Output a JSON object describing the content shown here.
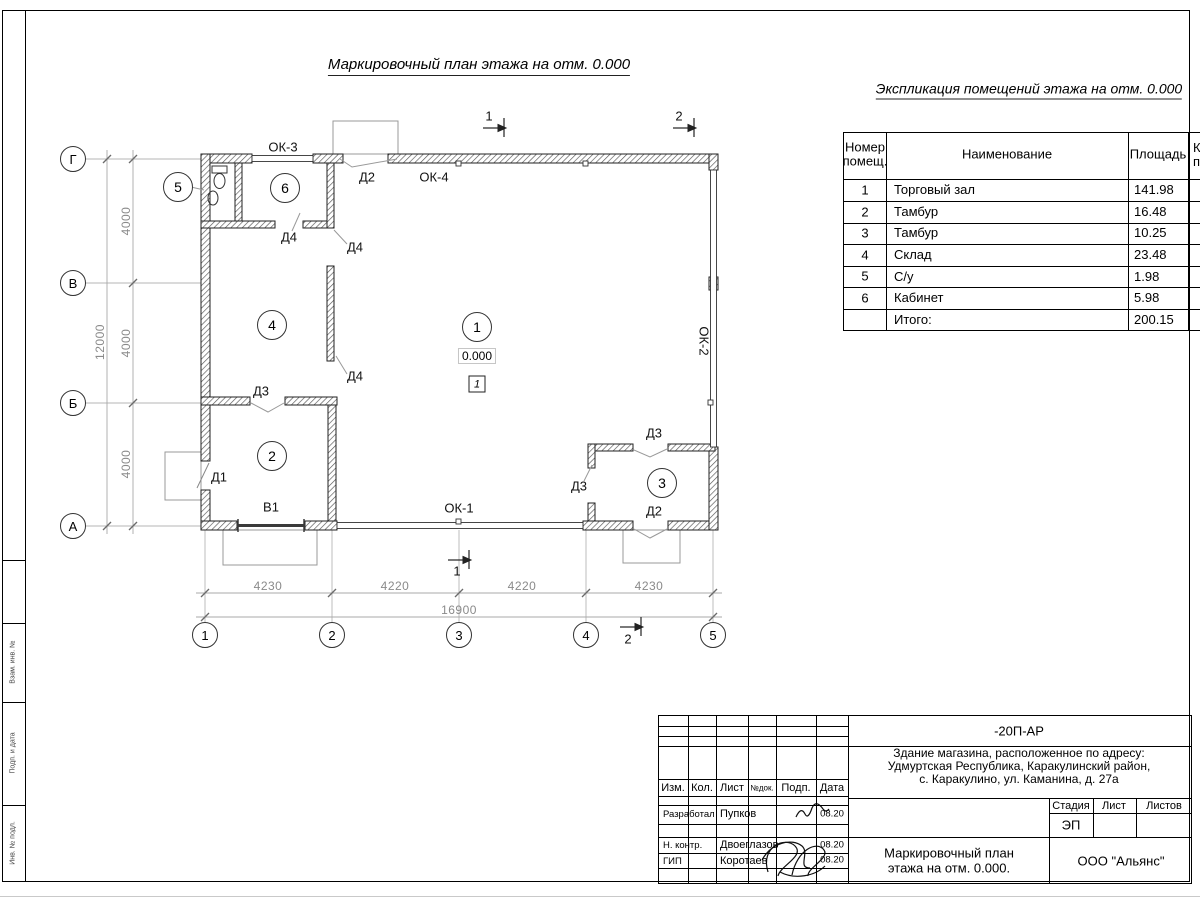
{
  "titles": {
    "plan": "Маркировочный план этажа на отм. 0.000",
    "explication": "Экспликация помещений этажа на отм. 0.000"
  },
  "explication": {
    "header": {
      "num1": "Номер",
      "num2": "помещ.",
      "name": "Наименование",
      "area": "Площадь",
      "cat1": "Кат.",
      "cat2": "пом."
    },
    "rows": [
      {
        "num": "1",
        "name": "Торговый зал",
        "area": "141.98"
      },
      {
        "num": "2",
        "name": "Тамбур",
        "area": "16.48"
      },
      {
        "num": "3",
        "name": "Тамбур",
        "area": "10.25"
      },
      {
        "num": "4",
        "name": "Склад",
        "area": "23.48"
      },
      {
        "num": "5",
        "name": "С/у",
        "area": "1.98"
      },
      {
        "num": "6",
        "name": "Кабинет",
        "area": "5.98"
      }
    ],
    "total": {
      "label": "Итого:",
      "area": "200.15"
    }
  },
  "plan": {
    "windows": {
      "ok1": "ОК-1",
      "ok2": "ОК-2",
      "ok3": "ОК-3",
      "ok4": "ОК-4"
    },
    "doors": {
      "d1": "Д1",
      "d2_top": "Д2",
      "d2_bottom": "Д2",
      "d3_room2": "Д3",
      "d3_left": "Д3",
      "d3_top": "Д3",
      "d4_a": "Д4",
      "d4_b": "Д4",
      "d4_c": "Д4",
      "v1": "В1"
    },
    "rooms": {
      "r1": "1",
      "r2": "2",
      "r3": "3",
      "r4": "4",
      "r5": "5",
      "r6": "6"
    },
    "elevation": "0.000",
    "floor_mark": "1",
    "sections": {
      "s1": "1",
      "s2": "2"
    }
  },
  "axes": {
    "horizontal": [
      "Г",
      "В",
      "Б",
      "А"
    ],
    "vertical": [
      "1",
      "2",
      "3",
      "4",
      "5"
    ]
  },
  "dimensions": {
    "left": [
      "4000",
      "4000",
      "4000"
    ],
    "left_total": "12000",
    "bottom": [
      "4230",
      "4220",
      "4220",
      "4230"
    ],
    "bottom_total": "16900"
  },
  "titleblock": {
    "code": "-20П-АР",
    "address": [
      "Здание магазина, расположенное по адресу:",
      "Удмуртская Республика, Каракулинский район,",
      "с. Каракулино, ул. Каманина, д. 27а"
    ],
    "cols": {
      "izm": "Изм.",
      "kol": "Кол.",
      "list": "Лист",
      "ndoc": "№док.",
      "podp": "Подп.",
      "data": "Дата"
    },
    "stage_header": {
      "stage": "Стадия",
      "sheet": "Лист",
      "sheets": "Листов"
    },
    "stage_value": "ЭП",
    "doc_title": [
      "Маркировочный план",
      "этажа на отм. 0.000."
    ],
    "org": "ООО \"Альянс\"",
    "people": [
      {
        "role": "Разработал",
        "name": "Пупков",
        "date": "08.20"
      },
      {
        "role": "Н. контр.",
        "name": "Двоеглазов",
        "date": "08.20"
      },
      {
        "role": "ГИП",
        "name": "Коротаев",
        "date": "08.20"
      }
    ]
  },
  "side_stamp": {
    "labels": [
      "Взам. инв. №",
      "Подп. и дата",
      "Инв. № подл."
    ]
  }
}
